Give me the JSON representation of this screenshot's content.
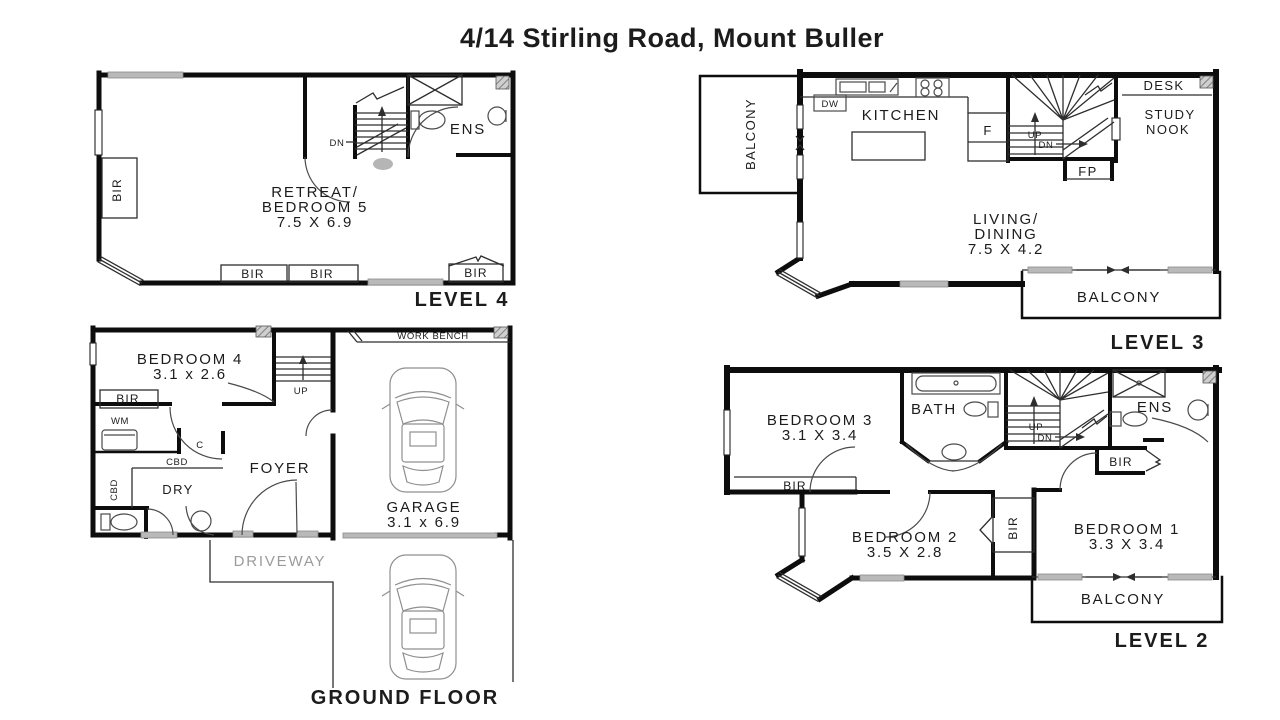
{
  "title": "4/14 Stirling Road, Mount Buller",
  "colors": {
    "background": "#ffffff",
    "wall": "#0d0d0d",
    "thin_line": "#2e2e2e",
    "window_gray": "#b9b9b9",
    "driveway_text": "#9b9b9b"
  },
  "plans": {
    "level4": {
      "title": "LEVEL 4",
      "labels": {
        "room_line1": "RETREAT/",
        "room_line2": "BEDROOM 5",
        "room_dims": "7.5 X 6.9",
        "ens": "ENS",
        "dn": "DN",
        "bir": "BIR"
      }
    },
    "level3": {
      "title": "LEVEL 3",
      "labels": {
        "balcony_upper": "BALCONY",
        "balcony_lower": "BALCONY",
        "dw": "DW",
        "kitchen": "KITCHEN",
        "fridge": "F",
        "up": "UP",
        "dn": "DN",
        "fp": "FP",
        "desk": "DESK",
        "study_line1": "STUDY",
        "study_line2": "NOOK",
        "living_line1": "LIVING/",
        "living_line2": "DINING",
        "living_dims": "7.5 X 4.2"
      }
    },
    "ground": {
      "title": "GROUND FLOOR",
      "labels": {
        "bedroom4": "BEDROOM 4",
        "bedroom4_dims": "3.1 x 2.6",
        "bir": "BIR",
        "wm": "WM",
        "c": "C",
        "cbd_h": "CBD",
        "cbd_v": "CBD",
        "dry": "DRY",
        "foyer": "FOYER",
        "up": "UP",
        "work_bench": "WORK BENCH",
        "garage": "GARAGE",
        "garage_dims": "3.1 x 6.9",
        "driveway": "DRIVEWAY"
      }
    },
    "level2": {
      "title": "LEVEL 2",
      "labels": {
        "bedroom3": "BEDROOM 3",
        "bedroom3_dims": "3.1 X 3.4",
        "bath": "BATH",
        "ens": "ENS",
        "up": "UP",
        "dn": "DN",
        "bir": "BIR",
        "bedroom2": "BEDROOM 2",
        "bedroom2_dims": "3.5 X 2.8",
        "bedroom1": "BEDROOM 1",
        "bedroom1_dims": "3.3 X 3.4",
        "balcony": "BALCONY"
      }
    }
  }
}
